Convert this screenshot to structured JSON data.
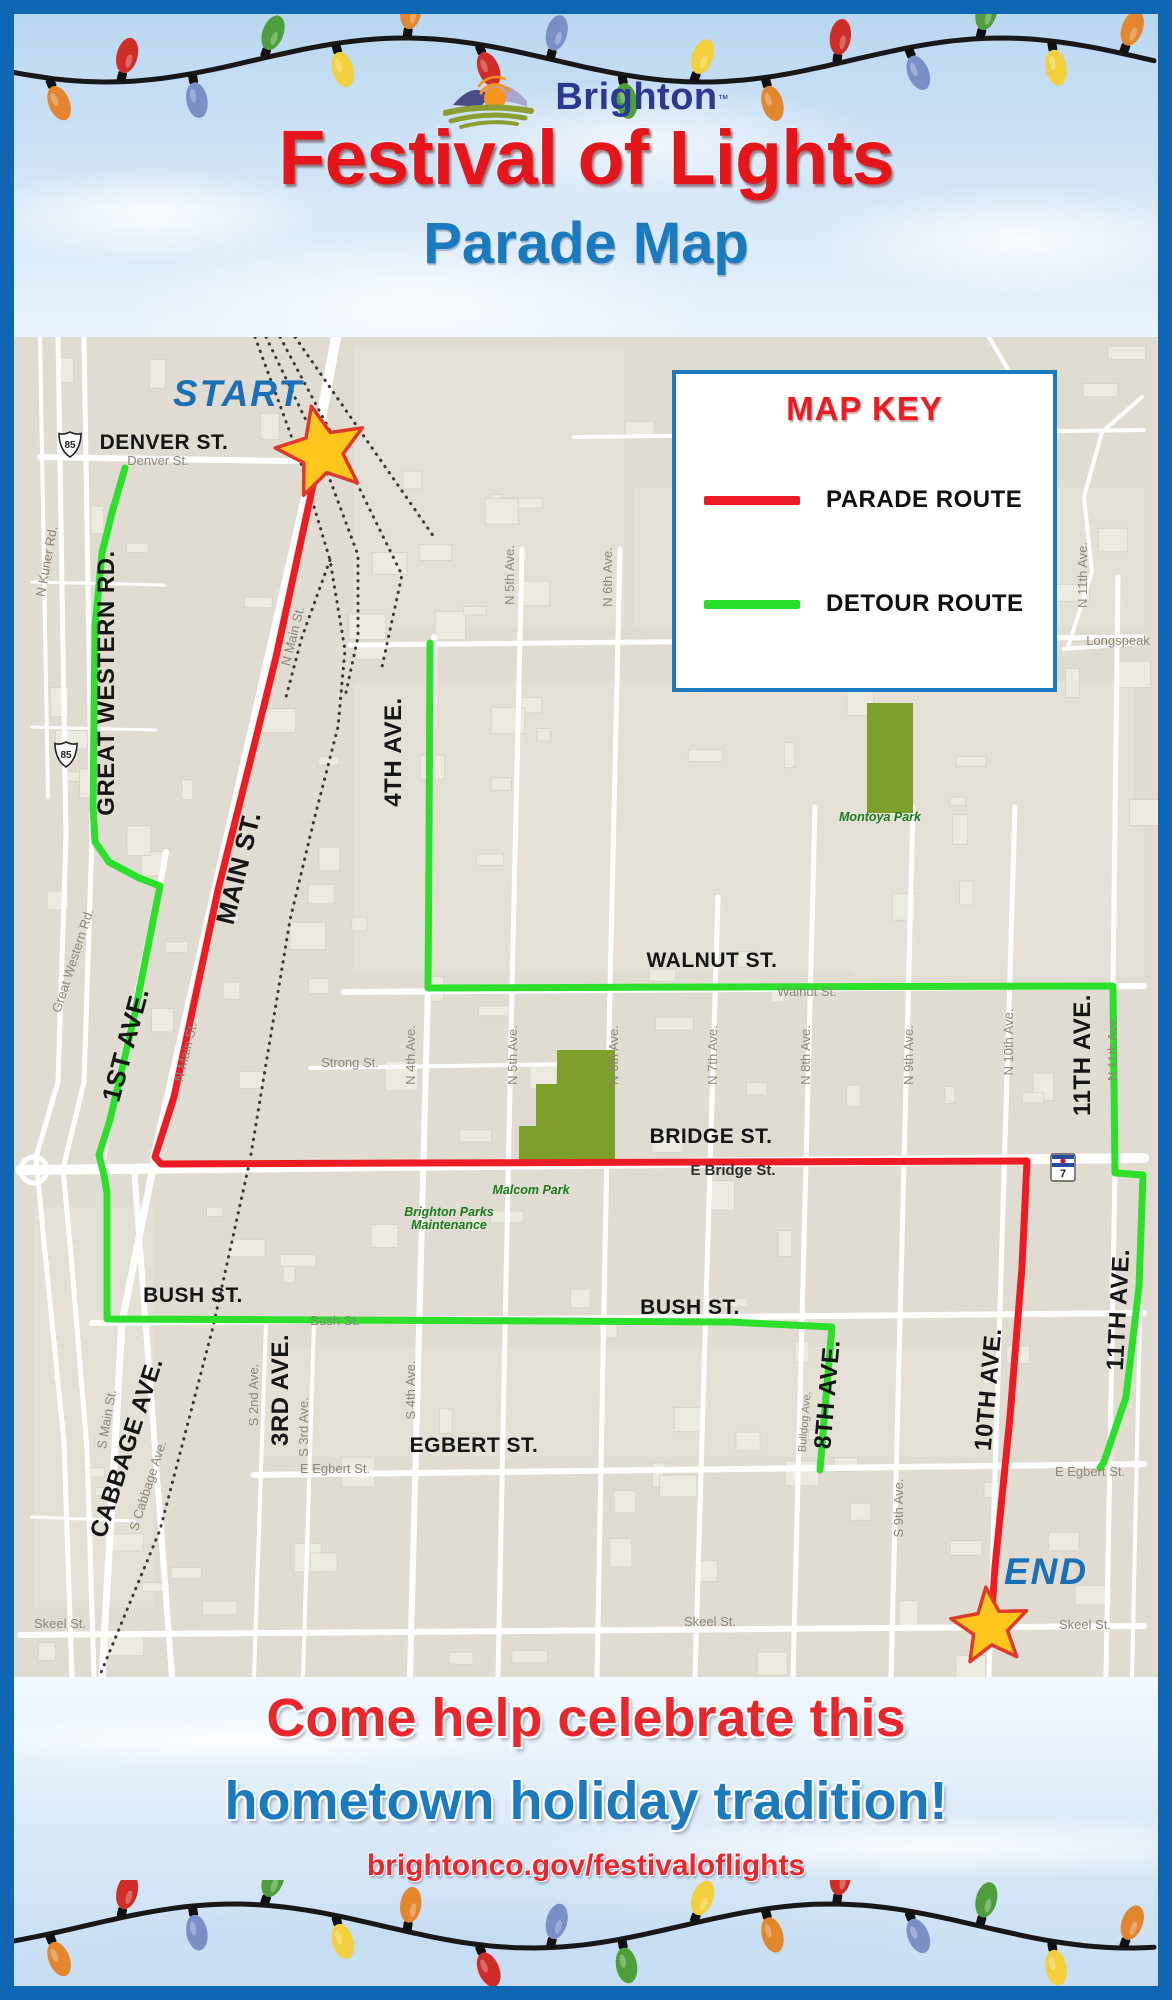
{
  "brand": {
    "name": "Brighton",
    "trademark": "TM"
  },
  "title": "Festival of Lights",
  "subtitle": "Parade Map",
  "map_key": {
    "title": "MAP KEY",
    "items": [
      {
        "label": "PARADE ROUTE",
        "color": "#ed1c24"
      },
      {
        "label": "DETOUR ROUTE",
        "color": "#2bdf2b"
      }
    ]
  },
  "footer": {
    "line1": "Come help celebrate this",
    "line2": "hometown holiday tradition!",
    "url": "brightonco.gov/festivaloflights"
  },
  "lights": {
    "wire_color": "#181818",
    "bulb_colors": [
      "#e2862f",
      "#cf2d28",
      "#7b8fc7",
      "#4f9e3c",
      "#f2cf3d"
    ]
  },
  "map": {
    "background": "#e0dcd2",
    "road_color": "#ffffff",
    "building_color": "#edeae0",
    "park_color": "#7da02c",
    "rail_color": "#3a3a3a",
    "star_fill": "#ffc61e",
    "star_stroke": "#e0392a",
    "label_bold_color": "#161616",
    "label_small_color": "#8d8679",
    "label_park_color": "#1e7a1e",
    "start": {
      "label": "START",
      "label_x": 224,
      "label_y": 69,
      "star_x": 308,
      "star_y": 115,
      "star_r": 47
    },
    "end": {
      "label": "END",
      "label_x": 1032,
      "label_y": 1247,
      "star_x": 976,
      "star_y": 1290,
      "star_r": 40
    },
    "parade_route": [
      [
        308,
        128
      ],
      [
        299,
        148
      ],
      [
        262,
        320
      ],
      [
        239,
        413
      ],
      [
        204,
        553
      ],
      [
        160,
        760
      ],
      [
        141,
        820
      ],
      [
        147,
        827
      ],
      [
        400,
        826
      ],
      [
        1013,
        824
      ],
      [
        1008,
        930
      ],
      [
        996,
        1080
      ],
      [
        981,
        1230
      ],
      [
        977,
        1288
      ]
    ],
    "detour_routes": [
      [
        [
          111,
          131
        ],
        [
          99,
          172
        ],
        [
          88,
          216
        ],
        [
          81,
          290
        ],
        [
          79,
          470
        ],
        [
          81,
          505
        ],
        [
          95,
          525
        ],
        [
          125,
          541
        ],
        [
          146,
          549
        ],
        [
          120,
          680
        ],
        [
          96,
          783
        ],
        [
          85,
          818
        ],
        [
          90,
          838
        ],
        [
          93,
          856
        ],
        [
          93,
          982
        ],
        [
          540,
          984
        ],
        [
          716,
          985
        ],
        [
          818,
          990
        ],
        [
          812,
          1060
        ],
        [
          806,
          1133
        ]
      ],
      [
        [
          416,
          306
        ],
        [
          415,
          520
        ],
        [
          414,
          651
        ],
        [
          700,
          650
        ],
        [
          1099,
          649
        ],
        [
          1100,
          750
        ],
        [
          1101,
          836
        ],
        [
          1129,
          838
        ],
        [
          1125,
          950
        ],
        [
          1112,
          1060
        ],
        [
          1090,
          1125
        ],
        [
          1086,
          1131
        ]
      ]
    ],
    "roads": [
      {
        "w": 6,
        "pts": [
          [
            26,
            120
          ],
          [
            332,
            125
          ]
        ]
      },
      {
        "w": 4,
        "pts": [
          [
            560,
            100
          ],
          [
            1130,
            93
          ]
        ]
      },
      {
        "w": 5,
        "pts": [
          [
            336,
            308
          ],
          [
            1130,
            300
          ]
        ]
      },
      {
        "w": 4,
        "pts": [
          [
            1128,
            60
          ],
          [
            1088,
            95
          ],
          [
            1070,
            160
          ],
          [
            1078,
            235
          ],
          [
            1054,
            310
          ]
        ]
      },
      {
        "w": 4,
        "pts": [
          [
            1050,
            312
          ],
          [
            1130,
            306
          ]
        ]
      },
      {
        "w": 6,
        "pts": [
          [
            330,
            655
          ],
          [
            1130,
            649
          ]
        ]
      },
      {
        "w": 4,
        "pts": [
          [
            296,
            731
          ],
          [
            565,
            727
          ]
        ]
      },
      {
        "w": 10,
        "pts": [
          [
            6,
            833
          ],
          [
            1130,
            821
          ]
        ]
      },
      {
        "w": 6,
        "pts": [
          [
            78,
            986
          ],
          [
            1130,
            976
          ]
        ]
      },
      {
        "w": 6,
        "pts": [
          [
            240,
            1138
          ],
          [
            1130,
            1127
          ]
        ]
      },
      {
        "w": 6,
        "pts": [
          [
            6,
            1298
          ],
          [
            1130,
            1289
          ]
        ]
      },
      {
        "w": 10,
        "pts": [
          [
            322,
            0
          ],
          [
            296,
            143
          ],
          [
            141,
            821
          ]
        ]
      },
      {
        "w": 7,
        "pts": [
          [
            141,
            821
          ],
          [
            108,
            985
          ],
          [
            88,
            1340
          ]
        ]
      },
      {
        "w": 6,
        "pts": [
          [
            152,
            515
          ],
          [
            146,
            549
          ],
          [
            96,
            783
          ],
          [
            88,
            826
          ]
        ]
      },
      {
        "w": 6,
        "pts": [
          [
            120,
            830
          ],
          [
            158,
            1340
          ]
        ]
      },
      {
        "w": 6,
        "pts": [
          [
            420,
            300
          ],
          [
            414,
            651
          ],
          [
            396,
            1340
          ]
        ]
      },
      {
        "w": 5,
        "pts": [
          [
            508,
            212
          ],
          [
            498,
            651
          ],
          [
            484,
            1340
          ]
        ]
      },
      {
        "w": 5,
        "pts": [
          [
            606,
            212
          ],
          [
            596,
            651
          ],
          [
            583,
            1340
          ]
        ]
      },
      {
        "w": 5,
        "pts": [
          [
            704,
            560
          ],
          [
            681,
            1340
          ]
        ]
      },
      {
        "w": 5,
        "pts": [
          [
            801,
            470
          ],
          [
            779,
            1340
          ]
        ]
      },
      {
        "w": 5,
        "pts": [
          [
            899,
            470
          ],
          [
            877,
            1340
          ]
        ]
      },
      {
        "w": 5,
        "pts": [
          [
            1001,
            470
          ],
          [
            975,
            1340
          ]
        ]
      },
      {
        "w": 5,
        "pts": [
          [
            1104,
            240
          ],
          [
            1099,
            650
          ],
          [
            1101,
            836
          ],
          [
            1092,
            1340
          ]
        ]
      },
      {
        "w": 4,
        "pts": [
          [
            1129,
            838
          ],
          [
            1118,
            1340
          ]
        ]
      },
      {
        "w": 4,
        "pts": [
          [
            252,
            986
          ],
          [
            240,
            1340
          ]
        ]
      },
      {
        "w": 4,
        "pts": [
          [
            300,
            986
          ],
          [
            289,
            1340
          ]
        ]
      },
      {
        "w": 5,
        "pts": [
          [
            44,
            0
          ],
          [
            52,
            500
          ],
          [
            44,
            745
          ],
          [
            22,
            820
          ],
          [
            30,
            905
          ],
          [
            50,
            1105
          ],
          [
            58,
            1340
          ]
        ]
      },
      {
        "w": 5,
        "pts": [
          [
            70,
            0
          ],
          [
            78,
            500
          ],
          [
            70,
            745
          ],
          [
            49,
            832
          ],
          [
            57,
            918
          ],
          [
            73,
            1112
          ],
          [
            80,
            1340
          ]
        ]
      },
      {
        "w": 4,
        "pts": [
          [
            26,
            0
          ],
          [
            34,
            460
          ]
        ]
      },
      {
        "w": 3,
        "pts": [
          [
            18,
            245
          ],
          [
            150,
            248
          ]
        ]
      },
      {
        "w": 3,
        "pts": [
          [
            18,
            390
          ],
          [
            142,
            393
          ]
        ]
      },
      {
        "w": 3,
        "pts": [
          [
            18,
            1180
          ],
          [
            120,
            1184
          ]
        ]
      },
      {
        "w": 4,
        "pts": [
          [
            975,
            0
          ],
          [
            1010,
            60
          ],
          [
            1008,
            95
          ]
        ]
      }
    ],
    "railroads": [
      [
        [
          241,
          0
        ],
        [
          286,
          123
        ],
        [
          316,
          223
        ],
        [
          331,
          313
        ],
        [
          324,
          390
        ],
        [
          300,
          483
        ],
        [
          276,
          583
        ],
        [
          236,
          823
        ],
        [
          199,
          990
        ],
        [
          146,
          1193
        ],
        [
          86,
          1338
        ]
      ],
      [
        [
          252,
          0
        ],
        [
          300,
          100
        ],
        [
          344,
          218
        ],
        [
          344,
          300
        ],
        [
          331,
          360
        ]
      ],
      [
        [
          266,
          0
        ],
        [
          330,
          120
        ],
        [
          388,
          238
        ],
        [
          368,
          330
        ]
      ],
      [
        [
          281,
          0
        ],
        [
          356,
          108
        ],
        [
          420,
          200
        ]
      ],
      [
        [
          316,
          223
        ],
        [
          288,
          300
        ],
        [
          272,
          360
        ]
      ]
    ],
    "roundabout": {
      "x": 20,
      "y": 833,
      "r": 13
    },
    "parks": {
      "montoya_rect": {
        "x": 853,
        "y": 366,
        "w": 46,
        "h": 110
      },
      "malcom_poly": [
        [
          543,
          713
        ],
        [
          601,
          713
        ],
        [
          601,
          824
        ],
        [
          505,
          824
        ],
        [
          505,
          789
        ],
        [
          522,
          789
        ],
        [
          522,
          747
        ],
        [
          543,
          747
        ]
      ]
    },
    "labels_bold": [
      {
        "t": "DENVER ST.",
        "x": 150,
        "y": 112,
        "s": 21
      },
      {
        "t": "GREAT WESTERN RD.",
        "x": 100,
        "y": 346,
        "s": 24,
        "r": -90
      },
      {
        "t": "MAIN ST.",
        "x": 233,
        "y": 533,
        "s": 26,
        "r": -76
      },
      {
        "t": "4TH AVE.",
        "x": 387,
        "y": 415,
        "s": 24,
        "r": -90
      },
      {
        "t": "1ST AVE.",
        "x": 120,
        "y": 710,
        "s": 26,
        "r": -75
      },
      {
        "t": "WALNUT ST.",
        "x": 698,
        "y": 630,
        "s": 21
      },
      {
        "t": "BRIDGE ST.",
        "x": 697,
        "y": 806,
        "s": 21
      },
      {
        "t": "BUSH ST.",
        "x": 179,
        "y": 965,
        "s": 21
      },
      {
        "t": "BUSH ST.",
        "x": 676,
        "y": 977,
        "s": 21
      },
      {
        "t": "CABBAGE AVE.",
        "x": 120,
        "y": 1113,
        "s": 24,
        "r": -72
      },
      {
        "t": "3RD AVE.",
        "x": 274,
        "y": 1053,
        "s": 24,
        "r": -90
      },
      {
        "t": "EGBERT ST.",
        "x": 460,
        "y": 1115,
        "s": 21
      },
      {
        "t": "8TH AVE.",
        "x": 821,
        "y": 1058,
        "s": 24,
        "r": -85
      },
      {
        "t": "10TH AVE.",
        "x": 982,
        "y": 1053,
        "s": 24,
        "r": -85
      },
      {
        "t": "11TH AVE.",
        "x": 1076,
        "y": 718,
        "s": 24,
        "r": -90
      },
      {
        "t": "11TH AVE.",
        "x": 1112,
        "y": 973,
        "s": 24,
        "r": -87
      }
    ],
    "labels_small": [
      {
        "t": "Denver St.",
        "x": 144,
        "y": 128
      },
      {
        "t": "N Kuner Rd.",
        "x": 37,
        "y": 225,
        "r": -80
      },
      {
        "t": "N Main St.",
        "x": 283,
        "y": 300,
        "r": -76
      },
      {
        "t": "N 5th Ave.",
        "x": 500,
        "y": 238,
        "r": -90
      },
      {
        "t": "N 6th Ave.",
        "x": 598,
        "y": 240,
        "r": -90
      },
      {
        "t": "N 11th Ave.",
        "x": 1073,
        "y": 238,
        "r": -90
      },
      {
        "t": "Longspeak",
        "x": 1104,
        "y": 308
      },
      {
        "t": "Great Western Rd.",
        "x": 63,
        "y": 625,
        "r": -72
      },
      {
        "t": "N Main St.",
        "x": 176,
        "y": 716,
        "r": -76
      },
      {
        "t": "Strong St.",
        "x": 336,
        "y": 730
      },
      {
        "t": "N 4th Ave.",
        "x": 401,
        "y": 718,
        "r": -90
      },
      {
        "t": "N 5th Ave.",
        "x": 503,
        "y": 718,
        "r": -90
      },
      {
        "t": "N 6th Ave.",
        "x": 604,
        "y": 718,
        "r": -90
      },
      {
        "t": "N 7th Ave.",
        "x": 703,
        "y": 718,
        "r": -90
      },
      {
        "t": "N 8th Ave.",
        "x": 796,
        "y": 718,
        "r": -90
      },
      {
        "t": "N 9th Ave.",
        "x": 899,
        "y": 718,
        "r": -90
      },
      {
        "t": "N 10th Ave.",
        "x": 999,
        "y": 705,
        "r": -90
      },
      {
        "t": "N 11th Ave.",
        "x": 1103,
        "y": 711,
        "r": -90
      },
      {
        "t": "Walnut St.",
        "x": 793,
        "y": 659
      },
      {
        "t": "E Bridge St.",
        "x": 719,
        "y": 838,
        "s": 15,
        "c": "#2e2e2e",
        "b": 1
      },
      {
        "t": "Bush St.",
        "x": 321,
        "y": 988
      },
      {
        "t": "S Main St.",
        "x": 97,
        "y": 1083,
        "r": -80
      },
      {
        "t": "S Cabbage Ave.",
        "x": 138,
        "y": 1150,
        "r": -72
      },
      {
        "t": "S 2nd Ave.",
        "x": 244,
        "y": 1058,
        "r": -90
      },
      {
        "t": "S 3rd Ave.",
        "x": 294,
        "y": 1090,
        "r": -90
      },
      {
        "t": "S 4th Ave.",
        "x": 401,
        "y": 1053,
        "r": -90
      },
      {
        "t": "Bulldog Ave.",
        "x": 794,
        "y": 1085,
        "r": -85,
        "s": 11
      },
      {
        "t": "E Egbert St.",
        "x": 321,
        "y": 1136
      },
      {
        "t": "E Egbert St.",
        "x": 1076,
        "y": 1139
      },
      {
        "t": "S 9th Ave.",
        "x": 889,
        "y": 1171,
        "r": -90
      },
      {
        "t": "Skeel St.",
        "x": 46,
        "y": 1291
      },
      {
        "t": "Skeel St.",
        "x": 696,
        "y": 1289
      },
      {
        "t": "Skeel St.",
        "x": 1071,
        "y": 1292
      }
    ],
    "labels_park": [
      {
        "t": "Montoya Park",
        "x": 866,
        "y": 484
      },
      {
        "t": "Malcom Park",
        "x": 517,
        "y": 857
      },
      {
        "t": "Brighton Parks",
        "x": 435,
        "y": 879
      },
      {
        "t": "Maintenance",
        "x": 435,
        "y": 892
      }
    ],
    "shields": [
      {
        "kind": "us",
        "num": "85",
        "x": 56,
        "y": 107
      },
      {
        "kind": "us",
        "num": "85",
        "x": 52,
        "y": 417
      },
      {
        "kind": "co",
        "num": "7",
        "x": 1049,
        "y": 831
      }
    ]
  }
}
